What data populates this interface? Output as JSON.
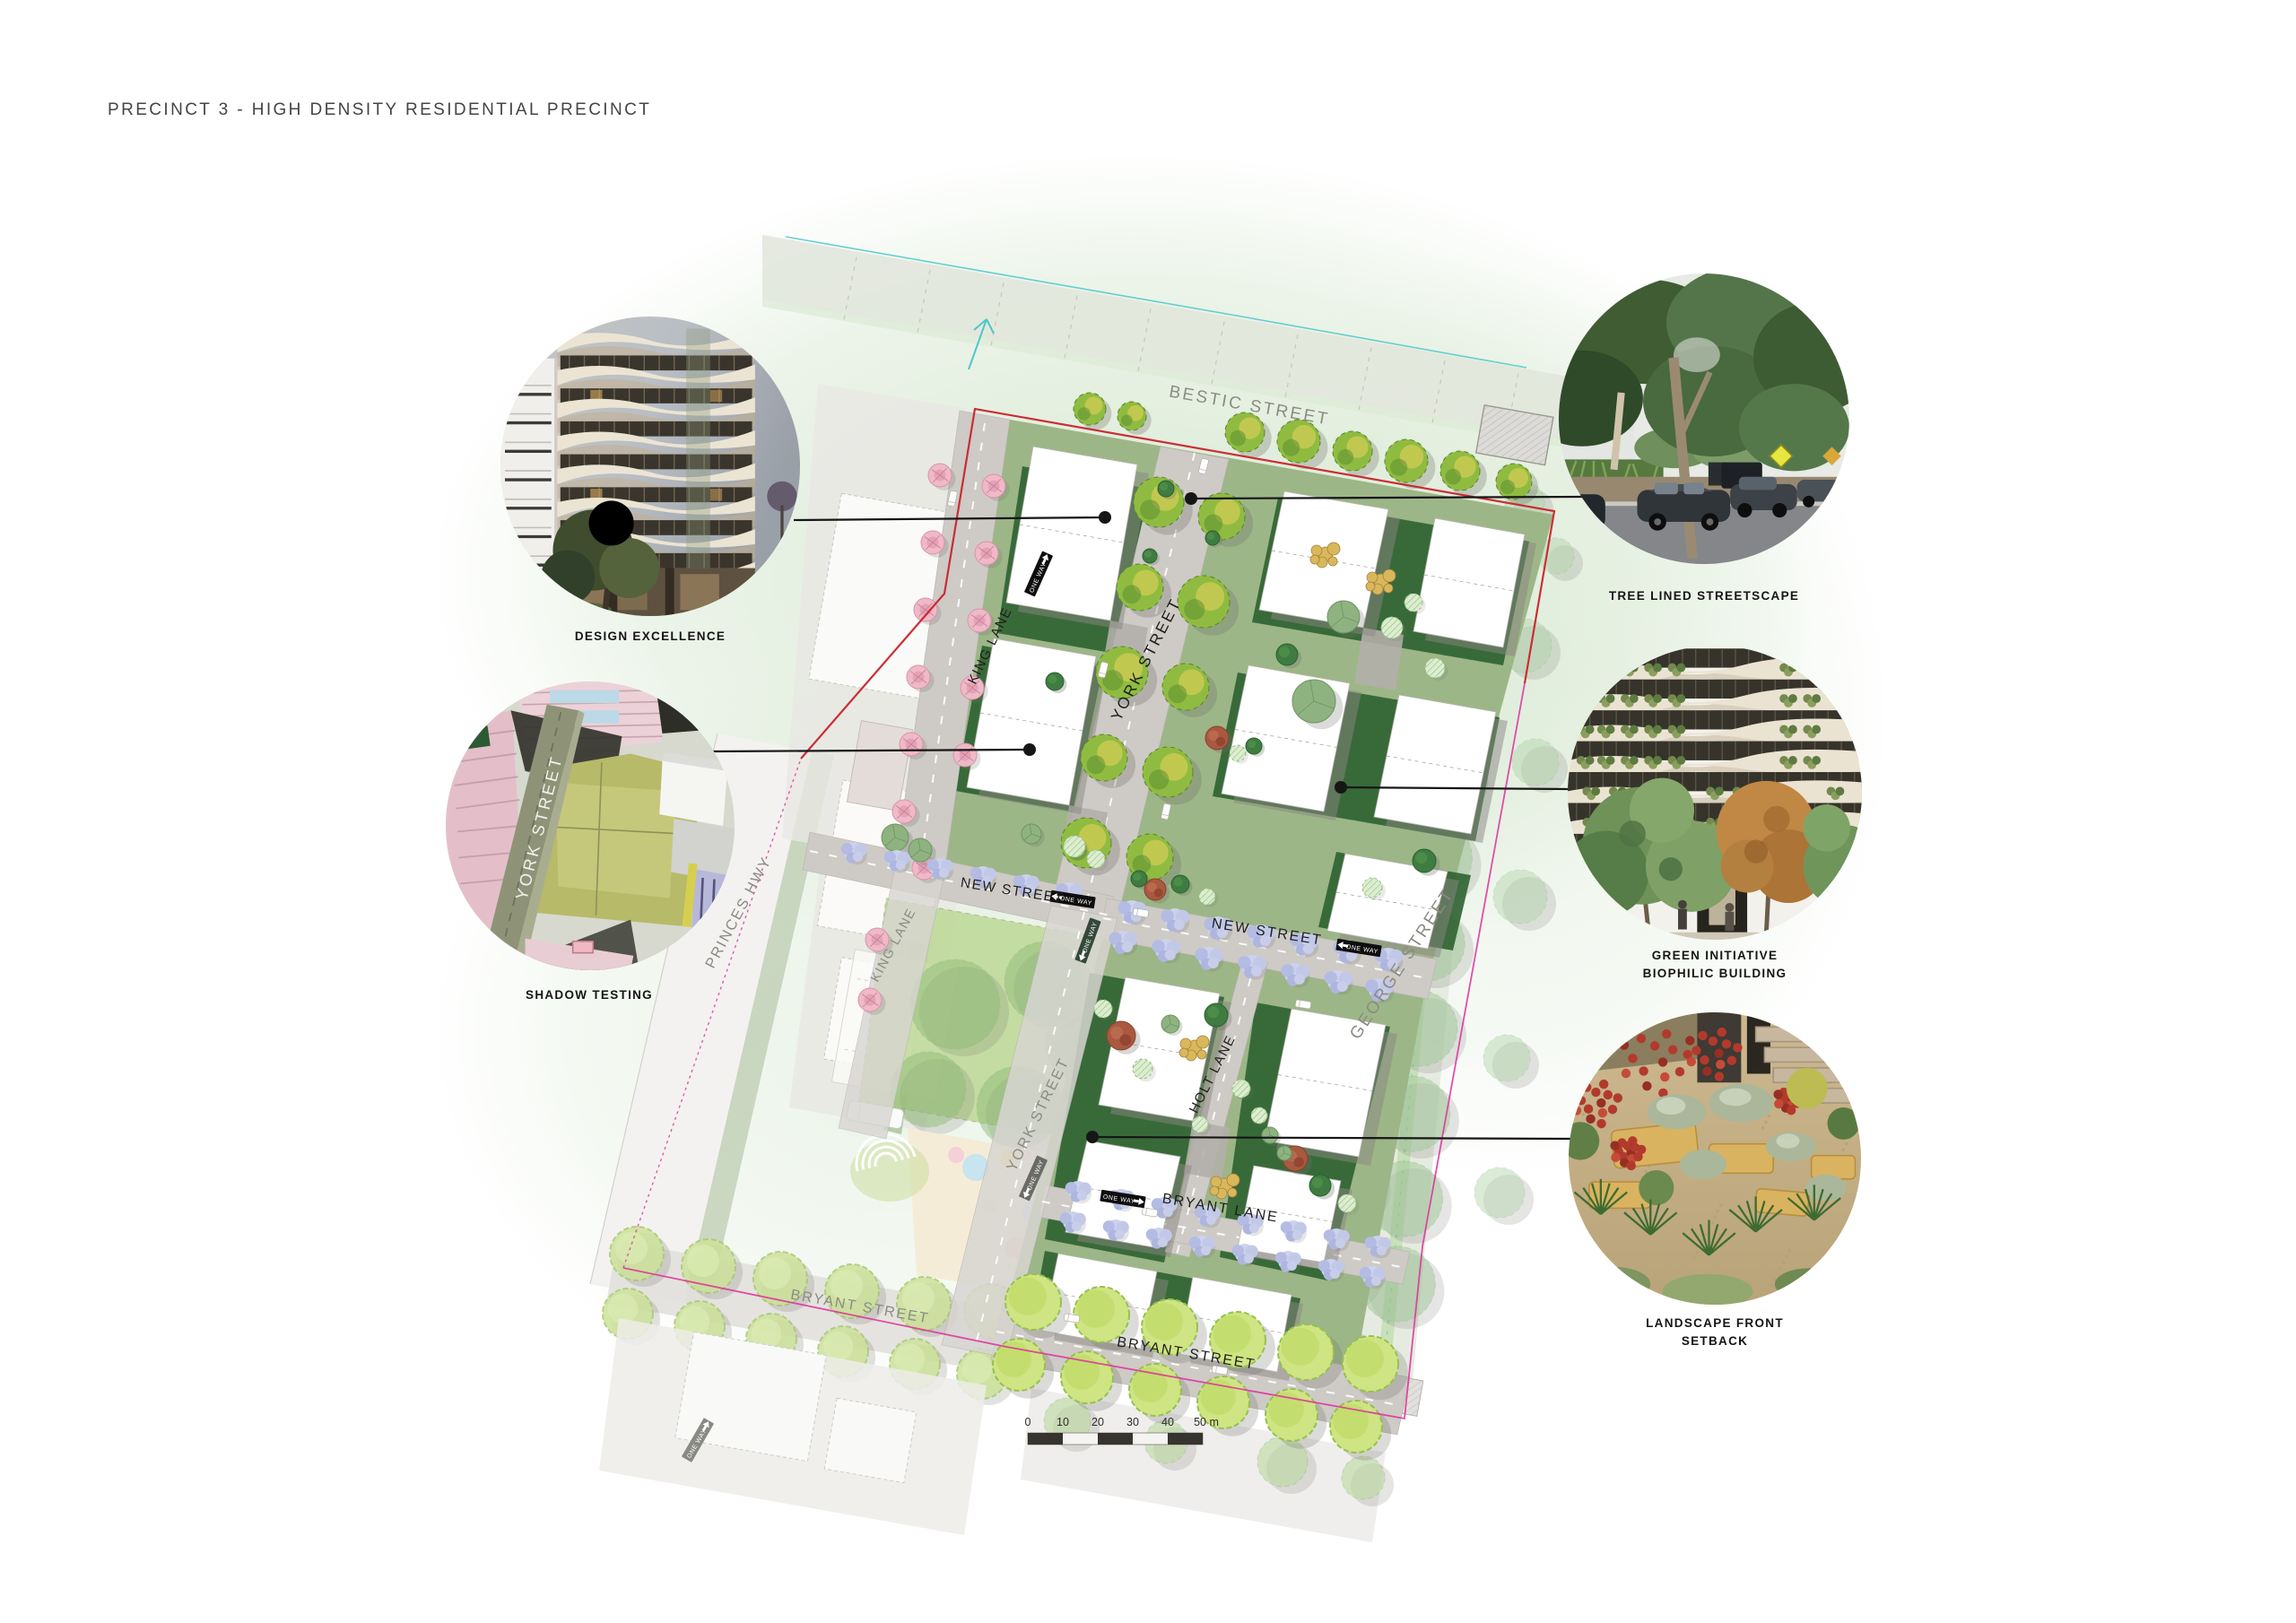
{
  "title": "PRECINCT 3 - HIGH DENSITY RESIDENTIAL PRECINCT",
  "callouts": {
    "design_excellence": {
      "label": "DESIGN EXCELLENCE"
    },
    "tree_lined": {
      "label": "TREE LINED STREETSCAPE"
    },
    "shadow_testing": {
      "label": "SHADOW TESTING",
      "inset_street": "YORK STREET"
    },
    "green_initiative": {
      "label_line1": "GREEN INITIATIVE",
      "label_line2": "BIOPHILIC BUILDING"
    },
    "landscape_setback": {
      "label_line1": "LANDSCAPE FRONT",
      "label_line2": "SETBACK"
    }
  },
  "map": {
    "streets": {
      "bestic": "BESTIC STREET",
      "king_lane_upper": "KING LANE",
      "king_lane_lower": "KING LANE",
      "york_upper": "YORK STREET",
      "york_lower": "YORK STREET",
      "new_left": "NEW STREET",
      "new_main": "NEW STREET",
      "george": "GEORGE STREET",
      "holt": "HOLT LANE",
      "bryant_lane": "BRYANT LANE",
      "bryant_main": "BRYANT STREET",
      "bryant_left": "BRYANT STREET",
      "princes_hwy": "PRINCES HWY"
    },
    "one_way": "ONE WAY",
    "scale": {
      "t0": "0",
      "t1": "10",
      "t2": "20",
      "t3": "30",
      "t4": "40",
      "t5": "50 m"
    }
  },
  "colors": {
    "boundary_red": "#c8242b",
    "boundary_magenta": "#df2f9b",
    "cyan": "#4cc7ca",
    "site_green": "#9db687",
    "courtyard_green": "#2e6231",
    "street_gray": "#cecac6",
    "callout_line": "#161616"
  }
}
